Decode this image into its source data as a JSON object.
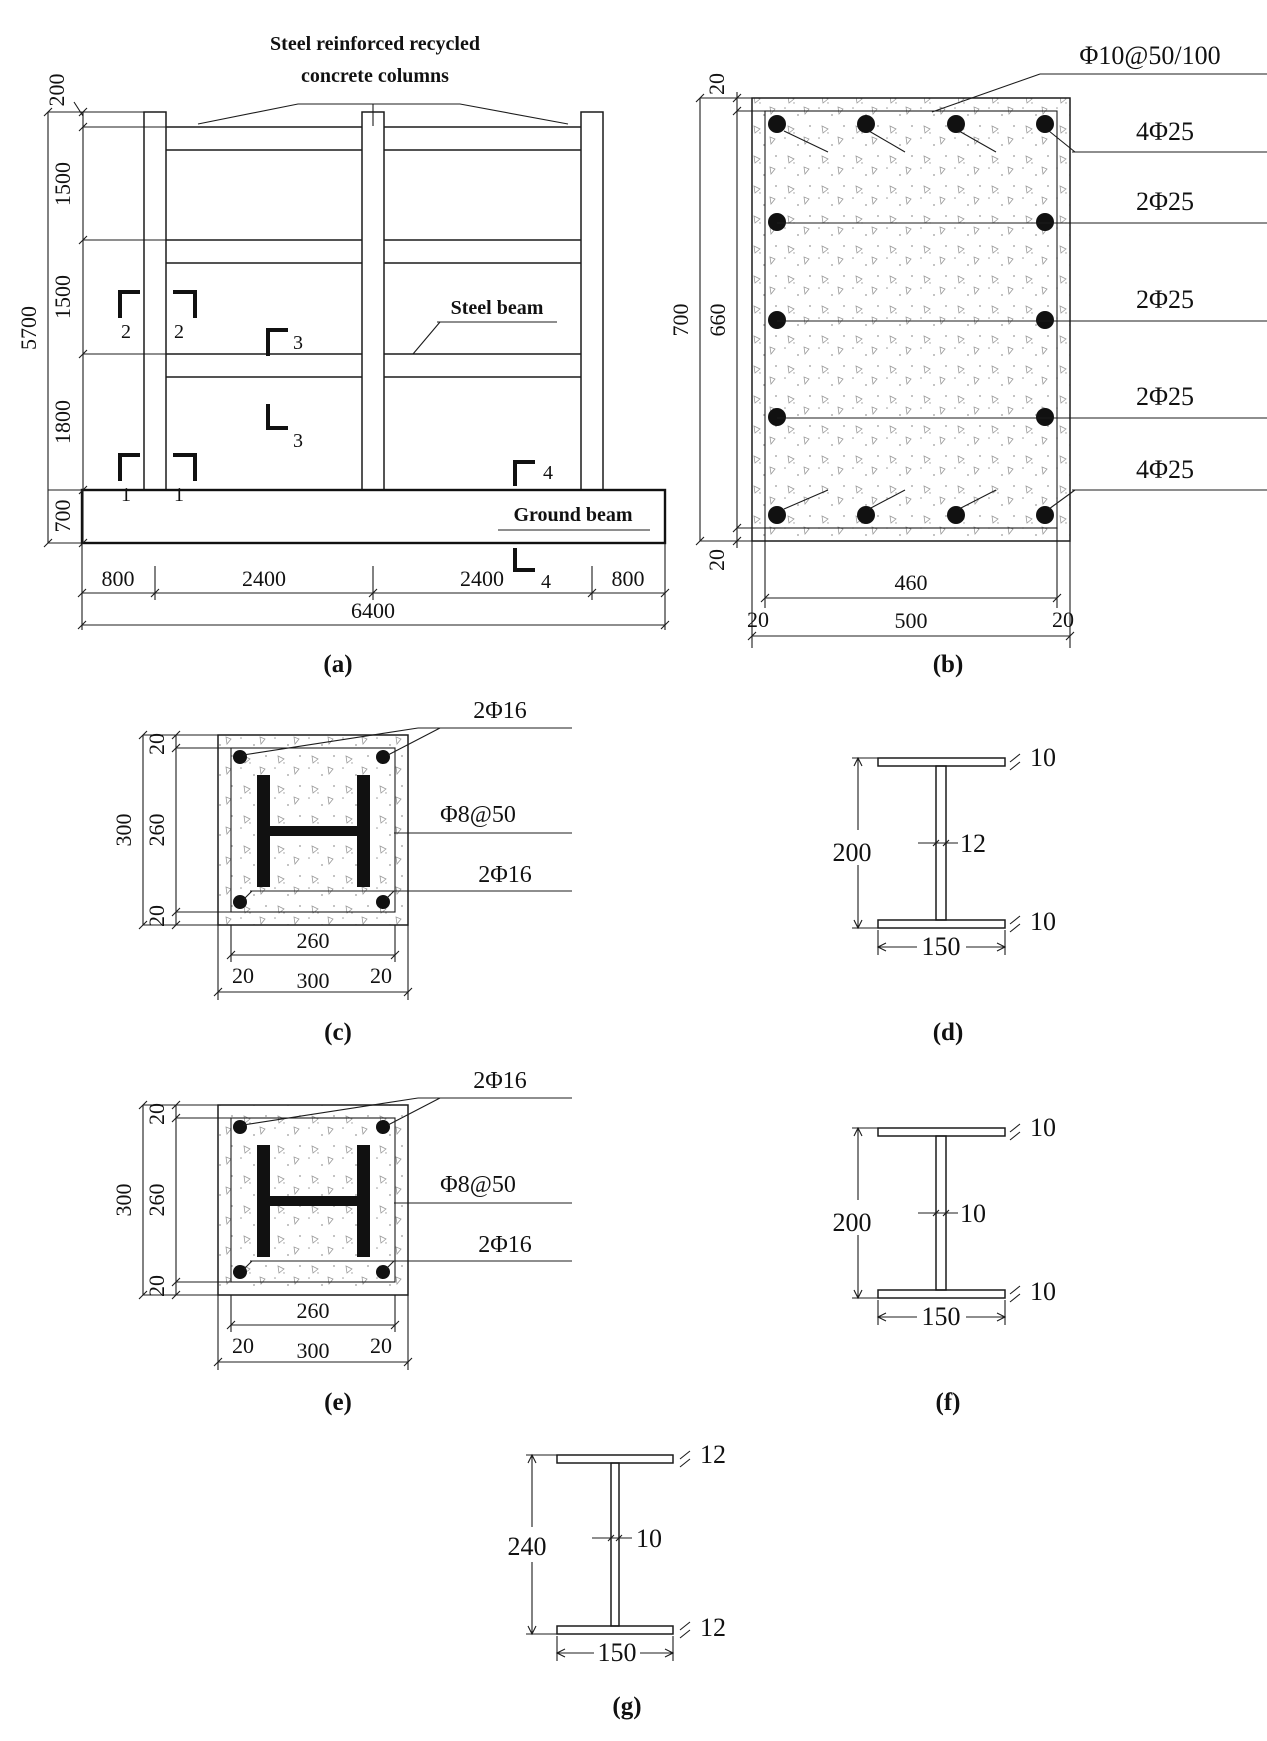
{
  "a": {
    "caption": "(a)",
    "title1": "Steel  reinforced recycled",
    "title2": "concrete columns",
    "steel_beam": "Steel beam",
    "ground_beam": "Ground beam",
    "d5700": "5700",
    "d200": "200",
    "d1500a": "1500",
    "d1500b": "1500",
    "d1800": "1800",
    "d700": "700",
    "d800l": "800",
    "d2400a": "2400",
    "d2400b": "2400",
    "d800r": "800",
    "d6400": "6400",
    "m1a": "1",
    "m1b": "1",
    "m2a": "2",
    "m2b": "2",
    "m3a": "3",
    "m3b": "3",
    "m4a": "4",
    "m4b": "4"
  },
  "b": {
    "caption": "(b)",
    "stirrups": "Φ10@50/100",
    "row_top": "4Φ25",
    "row2": "2Φ25",
    "row3": "2Φ25",
    "row4": "2Φ25",
    "row_bottom": "4Φ25",
    "d20t": "20",
    "d700": "700",
    "d660": "660",
    "d20b": "20",
    "d460": "460",
    "d20l": "20",
    "d500": "500",
    "d20r": "20"
  },
  "c": {
    "caption": "(c)",
    "top_bars": "2Φ16",
    "stirrups": "Φ8@50",
    "bottom_bars": "2Φ16",
    "d300v": "300",
    "d20t": "20",
    "d260v": "260",
    "d20b": "20",
    "d260h": "260",
    "d20l": "20",
    "d300h": "300",
    "d20r": "20"
  },
  "d": {
    "caption": "(d)",
    "height": "200",
    "web": "12",
    "top_flange": "10",
    "bottom_flange": "10",
    "width": "150"
  },
  "e": {
    "caption": "(e)",
    "top_bars": "2Φ16",
    "stirrups": "Φ8@50",
    "bottom_bars": "2Φ16",
    "d300v": "300",
    "d20t": "20",
    "d260v": "260",
    "d20b": "20",
    "d260h": "260",
    "d20l": "20",
    "d300h": "300",
    "d20r": "20"
  },
  "f": {
    "caption": "(f)",
    "height": "200",
    "web": "10",
    "top_flange": "10",
    "bottom_flange": "10",
    "width": "150"
  },
  "g": {
    "caption": "(g)",
    "height": "240",
    "web": "10",
    "top_flange": "12",
    "bottom_flange": "12",
    "width": "150"
  }
}
